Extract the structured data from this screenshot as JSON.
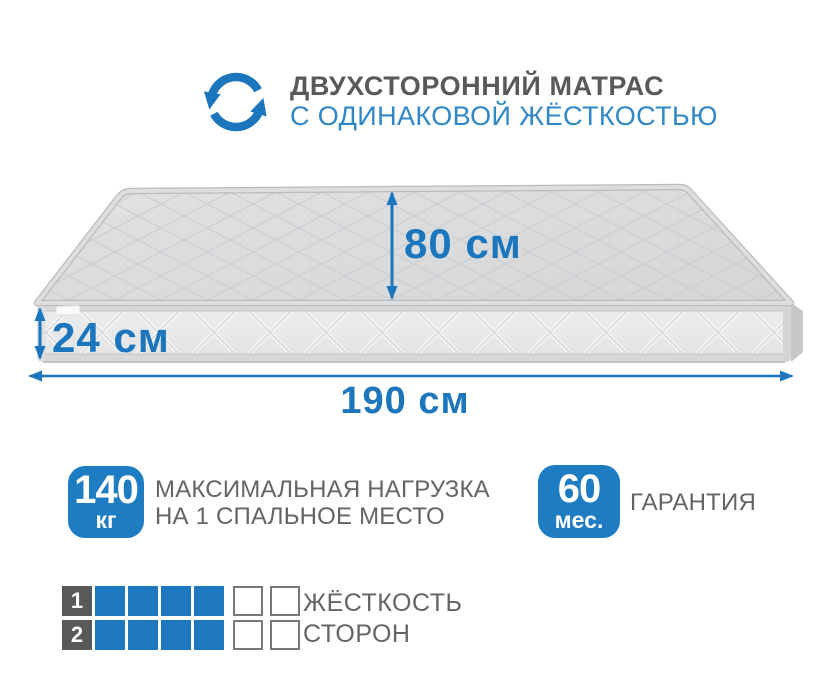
{
  "colors": {
    "accent": "#1b76bd",
    "badge": "#1e7cc2",
    "title_blue": "#2e87c8",
    "dark_gray": "#58595b",
    "text_gray": "#636466",
    "cell_blue": "#1e78bf",
    "cell_border": "#77787b"
  },
  "header": {
    "icon": "rotate-arrows",
    "title_line1": "ДВУХСТОРОННИЙ МАТРАС",
    "title_line2": "С ОДИНАКОВОЙ ЖЁСТКОСТЬЮ"
  },
  "diagram": {
    "subject": "mattress",
    "depth_label": "80 см",
    "height_label": "24 см",
    "width_label": "190 см"
  },
  "features": [
    {
      "badge_value": "140",
      "badge_unit": "кг",
      "label_line1": "МАКСИМАЛЬНАЯ НАГРУЗКА",
      "label_line2": "НА 1 СПАЛЬНОЕ МЕСТО"
    },
    {
      "badge_value": "60",
      "badge_unit": "мес.",
      "label_line1": "ГАРАНТИЯ",
      "label_line2": ""
    }
  ],
  "scale": {
    "rows": [
      {
        "number": "1",
        "filled": 4,
        "empty": 2
      },
      {
        "number": "2",
        "filled": 4,
        "empty": 2
      }
    ],
    "label_line1": "ЖЁСТКОСТЬ",
    "label_line2": "СТОРОН"
  }
}
